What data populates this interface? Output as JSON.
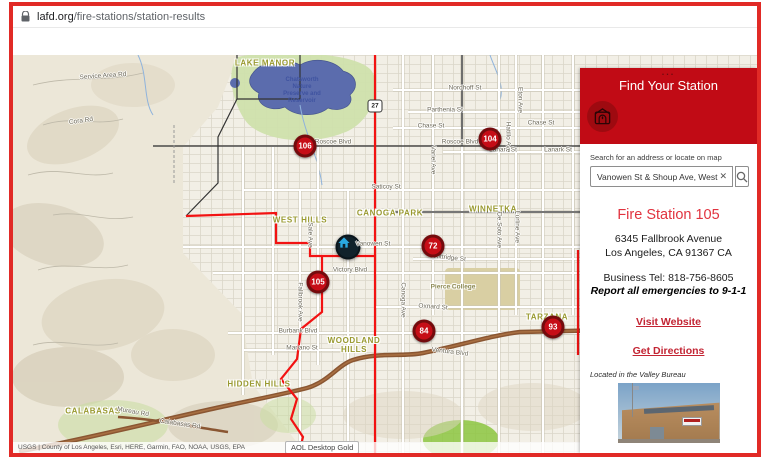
{
  "browser": {
    "url_domain": "lafd.org",
    "url_path": "/fire-stations/station-results"
  },
  "colors": {
    "frame_red": "#e12a26",
    "header_red": "#c10b15",
    "logo_red": "#9e0a10",
    "accent_red": "#e1333f",
    "link_red": "#c32433",
    "marker_red": "#c60d17",
    "marker_ring": "#740b0d",
    "selected_blue": "#2aaae1",
    "olive": "#99992f"
  },
  "panel": {
    "menu_dots": "...",
    "title": "Find Your Station",
    "search_label": "Search for an address or locate on map",
    "search_value": "Vanowen St & Shoup Ave, West",
    "clear_glyph": "✕",
    "station": {
      "name": "Fire Station 105",
      "address_line1": "6345 Fallbrook Avenue",
      "address_line2": "Los Angeles, CA 91367 CA",
      "phone": "Business Tel: 818-756-8605",
      "emergency_note": "Report all emergencies to 9-1-1",
      "website_link": "Visit Website",
      "directions_link": "Get Directions",
      "bureau_note": "Located in the Valley Bureau"
    }
  },
  "map": {
    "attribution": "USGS | County of Los Angeles, Esri, HERE, Garmin, FAO, NOAA, USGS, EPA",
    "tooltip": "AOL Desktop Gold",
    "highway_shield": "27",
    "markers": [
      {
        "num": "106",
        "x": 292,
        "y": 91
      },
      {
        "num": "104",
        "x": 477,
        "y": 84
      },
      {
        "num": "72",
        "x": 420,
        "y": 191
      },
      {
        "num": "105",
        "x": 305,
        "y": 227
      },
      {
        "num": "84",
        "x": 411,
        "y": 276
      },
      {
        "num": "93",
        "x": 540,
        "y": 272
      }
    ],
    "selected_location": {
      "x": 335,
      "y": 192
    },
    "place_labels": [
      {
        "text": "WEST HILLS",
        "x": 287,
        "y": 165
      },
      {
        "text": "CANOGA PARK",
        "x": 377,
        "y": 158
      },
      {
        "text": "WINNETKA",
        "x": 480,
        "y": 154
      },
      {
        "text": "WOODLAND\nHILLS",
        "x": 341,
        "y": 290
      },
      {
        "text": "HIDDEN HILLS",
        "x": 246,
        "y": 329
      },
      {
        "text": "CALABASAS",
        "x": 80,
        "y": 356
      },
      {
        "text": "TARZANA",
        "x": 534,
        "y": 262
      },
      {
        "text": "LAKE MANOR",
        "x": 252,
        "y": 8
      },
      {
        "text": "Pierce College",
        "x": 440,
        "y": 232,
        "cls": "place-sm"
      }
    ],
    "water_label": {
      "text": "Chatsworth\nNature\nPreserve and\nReservoir",
      "x": 289,
      "y": 36
    },
    "street_labels": [
      {
        "text": "Service Area Rd",
        "x": 90,
        "y": 21,
        "rot": -4
      },
      {
        "text": "Cora Rd",
        "x": 68,
        "y": 66,
        "rot": -8
      },
      {
        "text": "Nordhoff St",
        "x": 452,
        "y": 33
      },
      {
        "text": "Parthenia St",
        "x": 432,
        "y": 55
      },
      {
        "text": "Chase St",
        "x": 418,
        "y": 71
      },
      {
        "text": "Chase St",
        "x": 528,
        "y": 68
      },
      {
        "text": "Roscoe Blvd",
        "x": 320,
        "y": 87
      },
      {
        "text": "Roscoe Blvd",
        "x": 447,
        "y": 87
      },
      {
        "text": "Lanark St",
        "x": 490,
        "y": 95
      },
      {
        "text": "Lanark St",
        "x": 545,
        "y": 95
      },
      {
        "text": "Saticoy St",
        "x": 373,
        "y": 132
      },
      {
        "text": "Vanowen St",
        "x": 360,
        "y": 189
      },
      {
        "text": "Victory Blvd",
        "x": 337,
        "y": 215
      },
      {
        "text": "Kittridge St",
        "x": 437,
        "y": 203,
        "rot": 6
      },
      {
        "text": "Oxnard St",
        "x": 420,
        "y": 252,
        "rot": 4
      },
      {
        "text": "Burbank Blvd",
        "x": 285,
        "y": 276
      },
      {
        "text": "Mariano St",
        "x": 289,
        "y": 293
      },
      {
        "text": "Ventura Blvd",
        "x": 437,
        "y": 297,
        "rot": 7
      },
      {
        "text": "Mureau Rd",
        "x": 120,
        "y": 357,
        "rot": 10
      },
      {
        "text": "Calabasas Rd",
        "x": 167,
        "y": 369,
        "rot": 8
      },
      {
        "text": "Fallbrook Ave",
        "x": 287,
        "y": 247,
        "rot": 90
      },
      {
        "text": "Sale Ave",
        "x": 297,
        "y": 180,
        "rot": 90
      },
      {
        "text": "Canoga Ave",
        "x": 390,
        "y": 245,
        "rot": 90
      },
      {
        "text": "Variel Ave",
        "x": 420,
        "y": 105,
        "rot": 90
      },
      {
        "text": "De Soto Ave",
        "x": 486,
        "y": 175,
        "rot": 90
      },
      {
        "text": "Lurline Ave",
        "x": 504,
        "y": 172,
        "rot": 90
      },
      {
        "text": "Eton Ave",
        "x": 507,
        "y": 45,
        "rot": 90
      },
      {
        "text": "Hatillo Ave",
        "x": 495,
        "y": 82,
        "rot": 90
      }
    ]
  }
}
